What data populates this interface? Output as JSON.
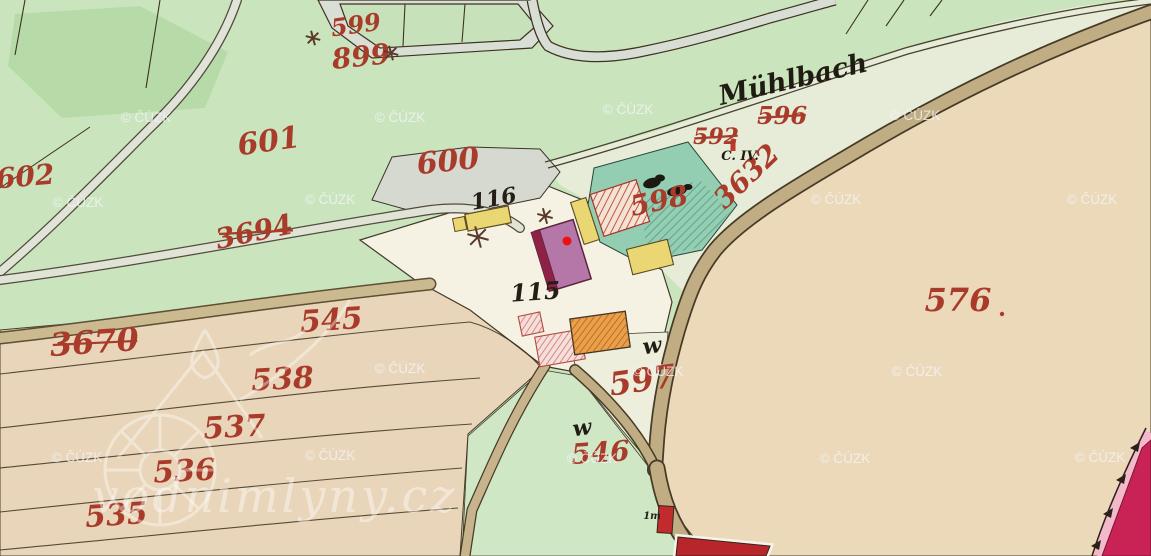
{
  "meta": {
    "description": "Historical hand-coloured cadastral map sheet with parcel numbers, buildings, roads and the Mühlbach stream"
  },
  "watermarks": {
    "small": "© ČÚZK",
    "large": "vodnimlyny.cz",
    "positions": [
      [
        146,
        122
      ],
      [
        400,
        122
      ],
      [
        628,
        114
      ],
      [
        915,
        120
      ],
      [
        78,
        207
      ],
      [
        330,
        204
      ],
      [
        836,
        204
      ],
      [
        1092,
        204
      ],
      [
        400,
        373
      ],
      [
        658,
        376
      ],
      [
        917,
        376
      ],
      [
        77,
        462
      ],
      [
        330,
        460
      ],
      [
        592,
        463
      ],
      [
        845,
        463
      ],
      [
        1100,
        462
      ]
    ]
  },
  "labels": {
    "stream": "Mühlbach",
    "section": "C. IV.",
    "red_parcels": [
      {
        "text": "599",
        "x": 357,
        "y": 33,
        "size": 24,
        "rot": -8,
        "strike": false
      },
      {
        "text": "899",
        "x": 362,
        "y": 66,
        "size": 28,
        "rot": -6,
        "strike": false
      },
      {
        "text": "601",
        "x": 270,
        "y": 151,
        "size": 30,
        "rot": -8,
        "strike": false
      },
      {
        "text": "600",
        "x": 449,
        "y": 171,
        "size": 30,
        "rot": -6,
        "strike": false
      },
      {
        "text": "602",
        "x": 26,
        "y": 186,
        "size": 28,
        "rot": -5,
        "strike": false
      },
      {
        "text": "3694",
        "x": 256,
        "y": 241,
        "size": 28,
        "rot": -12,
        "strike": true
      },
      {
        "text": "596",
        "x": 782,
        "y": 124,
        "size": 24,
        "rot": 0,
        "strike": true
      },
      {
        "text": "592",
        "x": 716,
        "y": 144,
        "size": 22,
        "rot": 0,
        "strike": true
      },
      {
        "text": "3632",
        "x": 753,
        "y": 183,
        "size": 28,
        "rot": -44,
        "strike": false
      },
      {
        "text": "598",
        "x": 661,
        "y": 210,
        "size": 28,
        "rot": -12,
        "strike": false
      },
      {
        "text": "545",
        "x": 332,
        "y": 330,
        "size": 30,
        "rot": -4,
        "strike": false
      },
      {
        "text": "3670",
        "x": 95,
        "y": 353,
        "size": 32,
        "rot": -4,
        "strike": true
      },
      {
        "text": "538",
        "x": 283,
        "y": 389,
        "size": 30,
        "rot": -3,
        "strike": false
      },
      {
        "text": "537",
        "x": 235,
        "y": 437,
        "size": 30,
        "rot": -3,
        "strike": false
      },
      {
        "text": "536",
        "x": 185,
        "y": 481,
        "size": 30,
        "rot": -3,
        "strike": false
      },
      {
        "text": "535",
        "x": 117,
        "y": 525,
        "size": 30,
        "rot": -4,
        "strike": false
      },
      {
        "text": "597",
        "x": 644,
        "y": 391,
        "size": 32,
        "rot": -8,
        "strike": false
      },
      {
        "text": "546",
        "x": 601,
        "y": 462,
        "size": 28,
        "rot": -4,
        "strike": false
      },
      {
        "text": "576",
        "x": 958,
        "y": 311,
        "size": 32,
        "rot": 0,
        "strike": false
      }
    ],
    "black_parcels": [
      {
        "text": "116",
        "x": 495,
        "y": 206,
        "size": 22,
        "rot": -10
      },
      {
        "text": "115",
        "x": 536,
        "y": 300,
        "size": 24,
        "rot": -4
      },
      {
        "text": "1m",
        "x": 652,
        "y": 519,
        "size": 10,
        "rot": 0
      }
    ],
    "meadow_marks": [
      {
        "text": "w",
        "x": 653,
        "y": 353,
        "size": 22,
        "rot": -8
      },
      {
        "text": "w",
        "x": 583,
        "y": 435,
        "size": 22,
        "rot": -8
      }
    ]
  },
  "symbols": {
    "mill_dot": {
      "x": 567,
      "y": 241,
      "color": "#ee1111"
    },
    "parcel_576_dot": {
      "x": 1002,
      "y": 314
    },
    "star_marks": [
      [
        478,
        237,
        22
      ],
      [
        545,
        216,
        16
      ],
      [
        313,
        38,
        15
      ],
      [
        391,
        53,
        15
      ]
    ],
    "tree_positions": [
      [
        652,
        183
      ],
      [
        677,
        191
      ]
    ]
  },
  "colors": {
    "meadow_green": "#cae5bd",
    "teal_parcel": "#93cdb2",
    "field_tan": "#ecd9ba",
    "white_parcel": "#f5f2e3",
    "road_fill": "#c0ad83",
    "masonry_red": "#b8262b",
    "garden_crimson": "#c92355",
    "mill_purple": "#b577a8",
    "wood_yellow": "#ead773",
    "number_red": "#a93b2a"
  }
}
